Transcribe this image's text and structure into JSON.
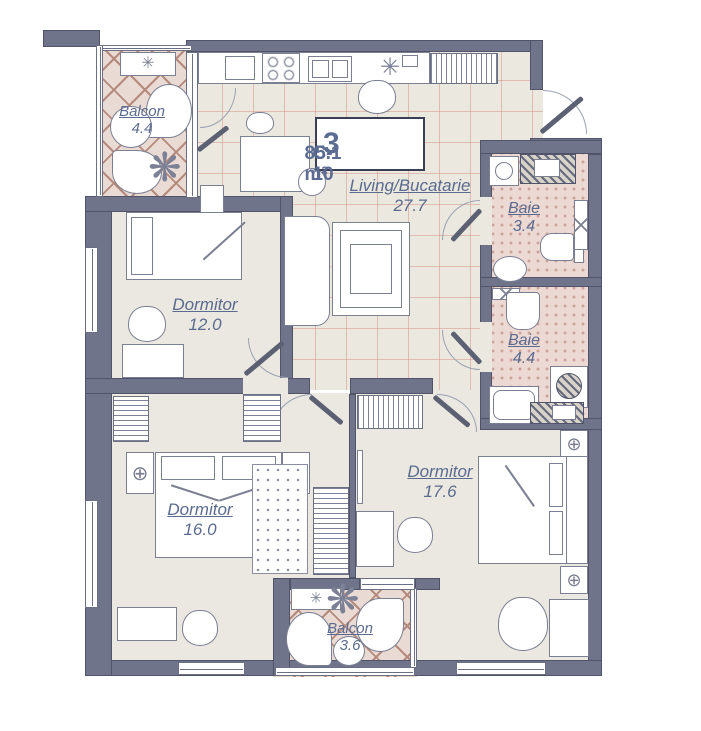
{
  "plan": {
    "title": {
      "rooms_count": "3",
      "unit_code": "C-10",
      "total_area": "85.1 m²"
    },
    "rooms": [
      {
        "id": "living",
        "name": "Living/Bucatarie",
        "area": "27.7"
      },
      {
        "id": "balcon-top",
        "name": "Balcon",
        "area": "4.4"
      },
      {
        "id": "baie-1",
        "name": "Baie",
        "area": "3.4"
      },
      {
        "id": "baie-2",
        "name": "Baie",
        "area": "4.4"
      },
      {
        "id": "dormitor-1",
        "name": "Dormitor",
        "area": "12.0"
      },
      {
        "id": "dormitor-2",
        "name": "Dormitor",
        "area": "16.0"
      },
      {
        "id": "dormitor-3",
        "name": "Dormitor",
        "area": "17.6"
      },
      {
        "id": "balcon-bottom",
        "name": "Balcon",
        "area": "3.6"
      }
    ],
    "glyphs": {
      "fan": "✳",
      "plant": "❋",
      "lamp": "⊕"
    },
    "colors": {
      "wall": "#70748a",
      "label_text": "#5b6b8f",
      "title_text": "#5c6b92",
      "balcony_tile": "#b5897b",
      "bath_tile": "#d9b3ab",
      "living_grid": "#e0b4a8",
      "room_floor": "#eae8e0"
    }
  }
}
